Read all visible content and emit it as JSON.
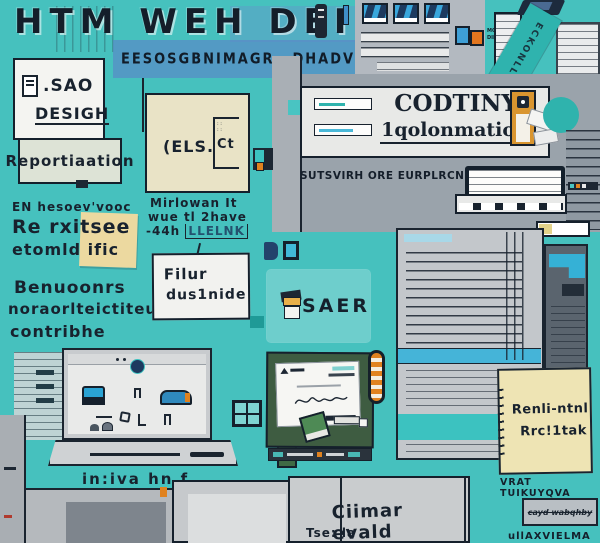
{
  "title": "HTM WEH DEI'",
  "banner": {
    "left": "EESOSGBNIMAGR",
    "right": "DHADVMBEITOI"
  },
  "design_card": {
    "line1": ".SAO",
    "line2": "DESIGH"
  },
  "report_card": {
    "label": "Reportiaation"
  },
  "notes_a": {
    "lines": [
      "EN hesoev'vooc",
      "Re rxitsee",
      "etomld ific"
    ]
  },
  "notes_b": {
    "lines": [
      "Benuoonrs",
      "noraorlteictiteu",
      "contribhe"
    ]
  },
  "cream_card": {
    "label": "(ELS.",
    "side_label": "Ct"
  },
  "hand_note": {
    "lines": [
      "Mirlowan It",
      "wue tl 2have"
    ],
    "line3_prefix": "-44h",
    "line3_link": "LLELNK"
  },
  "file_card": {
    "line1": "Filur",
    "line2": "dus1nide"
  },
  "saer_card": {
    "label": "SAER"
  },
  "coding_panel": {
    "line1": "CODTINY",
    "line2": "1qolonmation"
  },
  "subcaption": "SUTSVIRH ORE EURPLRCNCAL",
  "tiny_note": {
    "line1": "MOIFEIT",
    "line2": "DIFEIT?"
  },
  "ribbon": {
    "label": "ECKONLLS"
  },
  "sticky_note": {
    "line1": "Renli-ntnl",
    "line2": "Rrc!1tak",
    "caption": "VRAT TUIKUYQVA"
  },
  "scribble_box": {
    "text": "cayd wabqhby"
  },
  "bottom_right_text": "ullAXVIELMA",
  "laptop": {
    "caption": "in:iva hn f"
  },
  "contact_card": {
    "line1": "Ciimar evald",
    "line2": "Tse: la"
  },
  "colors": {
    "teal_background": "#46c1be",
    "ink": "#18222e",
    "accent_orange": "#e0821f",
    "accent_blue": "#3aa7dc",
    "banner_blue": "#6a8fd8",
    "sticky_yellow": "#eee4b4",
    "panel_green": "#3e5c41",
    "teal_circle": "#2fb3ad"
  }
}
